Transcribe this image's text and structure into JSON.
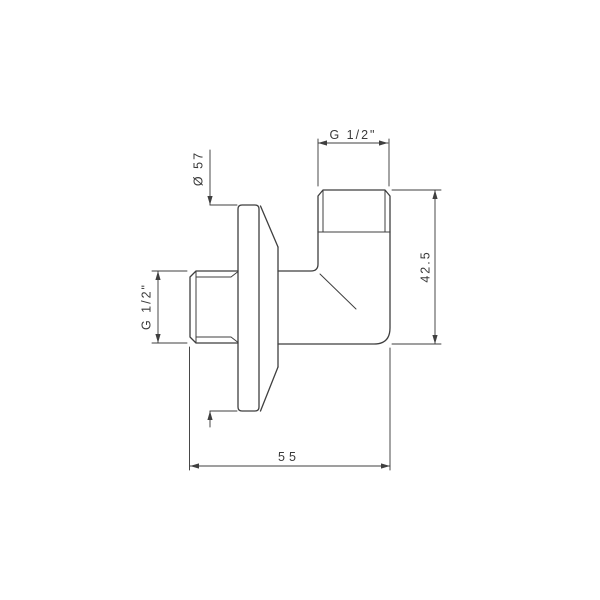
{
  "drawing": {
    "kind": "technical-drawing",
    "background": "#ffffff",
    "line_color": "#3f3f3f",
    "text_color": "#3a3a3a"
  },
  "dimensions": [
    {
      "id": "top-thread-size",
      "label": "G 1/2\"",
      "orientation": "horizontal"
    },
    {
      "id": "flange-diameter",
      "label": "Ø 57",
      "orientation": "vertical"
    },
    {
      "id": "left-thread-size",
      "label": "G 1/2\"",
      "orientation": "vertical"
    },
    {
      "id": "body-height",
      "label": "42.5",
      "orientation": "vertical"
    },
    {
      "id": "overall-width",
      "label": "55",
      "orientation": "horizontal"
    }
  ]
}
